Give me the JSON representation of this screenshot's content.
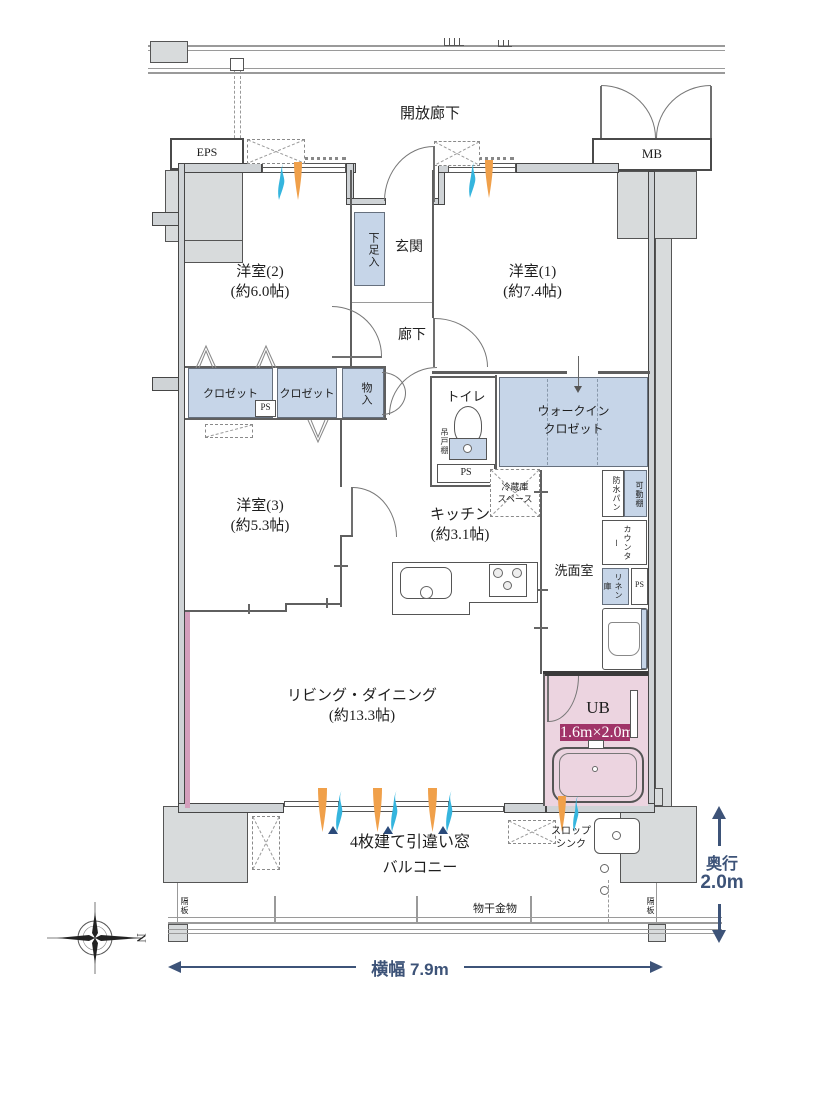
{
  "plan": {
    "open_corridor": "開放廊下",
    "eps": "EPS",
    "mb": "MB",
    "rooms": {
      "bedroom2_name": "洋室(2)",
      "bedroom2_size": "(約6.0帖)",
      "bedroom1_name": "洋室(1)",
      "bedroom1_size": "(約7.4帖)",
      "bedroom3_name": "洋室(3)",
      "bedroom3_size": "(約5.3帖)",
      "living_name": "リビング・ダイニング",
      "living_size": "(約13.3帖)",
      "kitchen_name": "キッチン",
      "kitchen_size": "(約3.1帖)",
      "entrance": "玄関",
      "hallway": "廊下",
      "washroom": "洗面室",
      "toilet": "トイレ",
      "wic_line1": "ウォークイン",
      "wic_line2": "クロゼット",
      "ub": "UB",
      "ub_size": "1.6m×2.0m",
      "balcony": "バルコニー"
    },
    "storage": {
      "shoe_box": "下足入",
      "closet_a": "クロゼット",
      "closet_b": "クロゼット",
      "mono_ire": "物入",
      "hanging_cabinet": "吊戸棚",
      "fridge_line1": "冷蔵庫",
      "fridge_line2": "スペース",
      "waterproof_pan": "防水パン",
      "movable_shelf": "可動棚",
      "counter": "カウンター",
      "linen": "リネン庫",
      "ps_1": "PS",
      "ps_2": "PS",
      "ps_3": "PS"
    },
    "annotations": {
      "sliding_window": "4枚建て引違い窓",
      "slop_line1": "スロップ",
      "slop_line2": "シンク",
      "drying_fixture": "物干金物",
      "partition_left": "隔板",
      "partition_right": "隔板"
    },
    "dimensions": {
      "width": "横幅 7.9m",
      "depth_label": "奥行",
      "depth_value": "2.0m",
      "north": "N"
    },
    "colors": {
      "closet_fill": "#c6d5e8",
      "ub_fill": "#ecd4e0",
      "ub_badge": "#a03468",
      "dimension_text": "#3d5378",
      "accent_wall": "#d49ebc",
      "airflow_orange": "#f0a04a",
      "airflow_blue": "#35b5de"
    }
  }
}
